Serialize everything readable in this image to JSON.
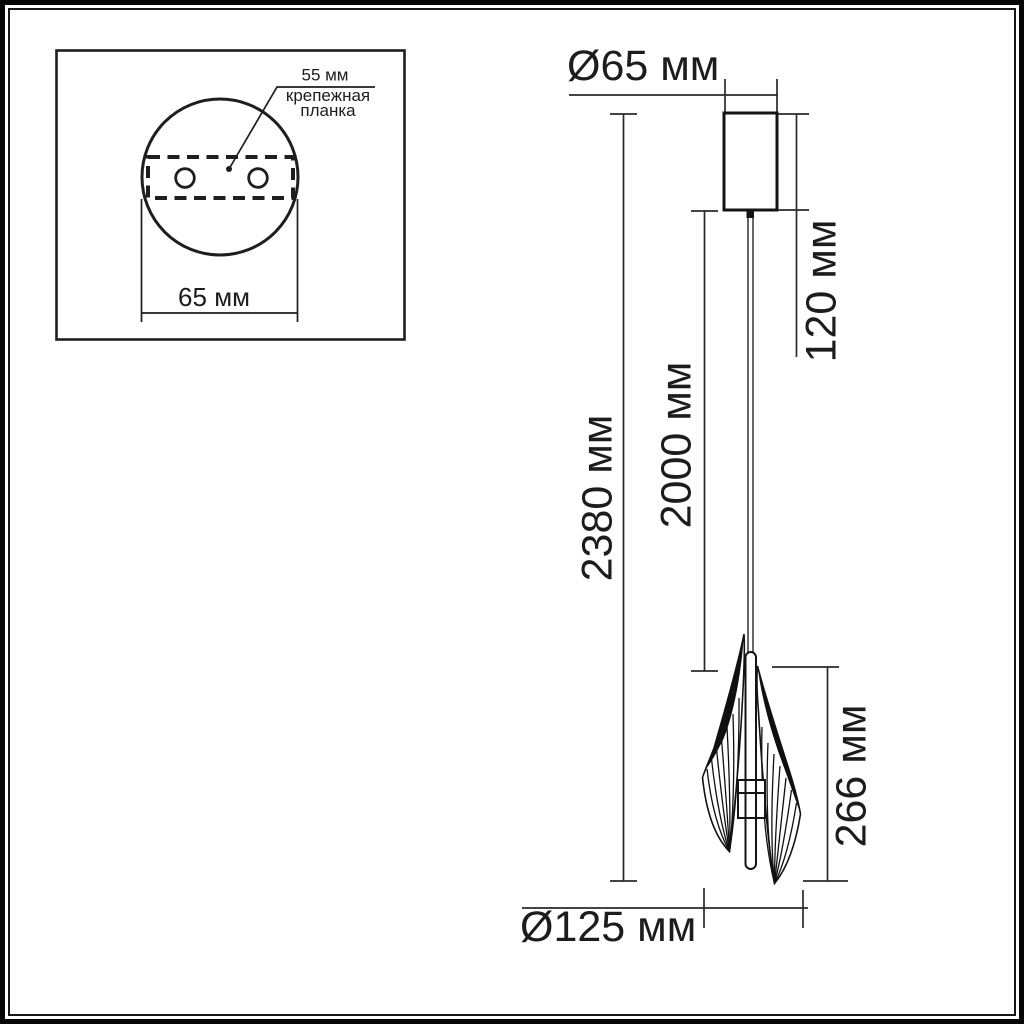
{
  "colors": {
    "background": "#ffffff",
    "ink": "#1c1c1c"
  },
  "inset": {
    "plate_dimension": "55 мм",
    "plate_name_line1": "крепежная",
    "plate_name_line2": "планка",
    "base_diameter": "65 мм"
  },
  "drawing": {
    "canopy_diameter": "Ø65 мм",
    "canopy_height": "120 мм",
    "overall_length": "2380 мм",
    "cable_length": "2000 мм",
    "shade_height": "266 мм",
    "shade_diameter": "Ø125 мм"
  }
}
